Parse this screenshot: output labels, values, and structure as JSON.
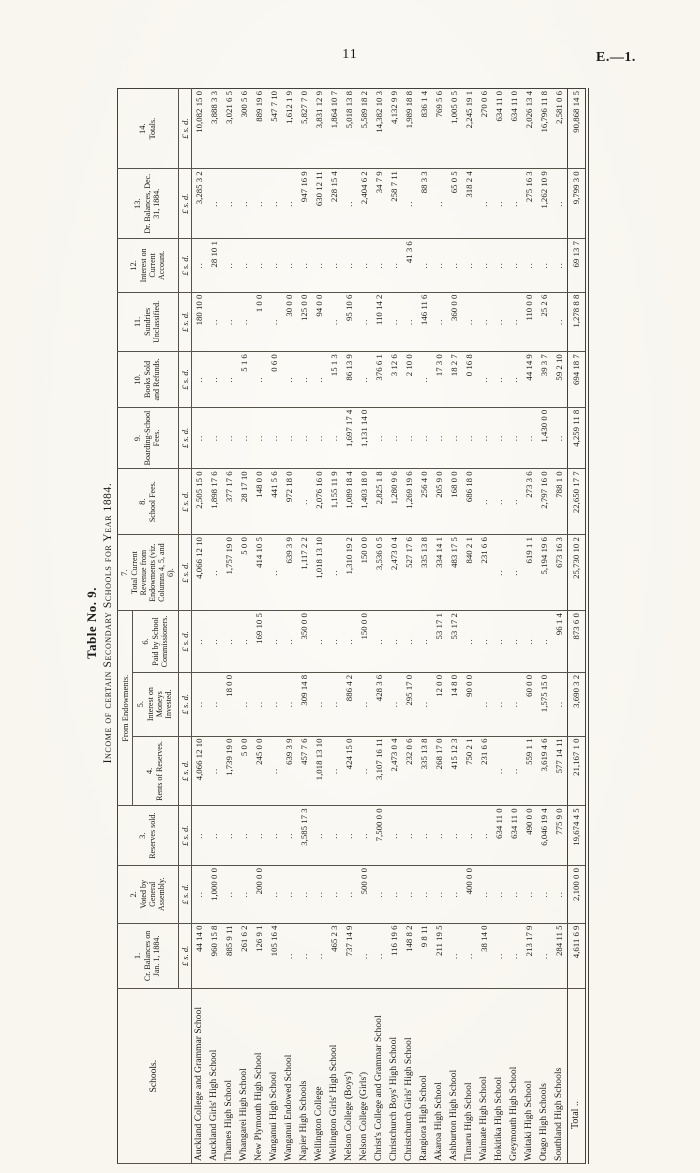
{
  "page": {
    "number": "11",
    "doc_ref": "E.—1."
  },
  "table": {
    "caption_line1": "Table No. 9.",
    "caption_line2": "Income of certain Secondary Schools for Year 1884.",
    "schools_header": "Schools.",
    "group_header": "From Endowments.",
    "money_unit": "£ s. d.",
    "columns": [
      {
        "num": "1.",
        "label": "Cr. Balances on Jan. 1, 1884.",
        "group": false
      },
      {
        "num": "2.",
        "label": "Voted by General Assembly.",
        "group": false
      },
      {
        "num": "3.",
        "label": "Reserves sold.",
        "group": false
      },
      {
        "num": "4.",
        "label": "Rents of Reserves.",
        "group": true
      },
      {
        "num": "5.",
        "label": "Interest on Moneys Invested.",
        "group": true
      },
      {
        "num": "6.",
        "label": "Paid by School Commissioners.",
        "group": true
      },
      {
        "num": "7.",
        "label": "Total Current Revenue from Endowments (viz. Columns 4, 5, and 6).",
        "group": false
      },
      {
        "num": "8.",
        "label": "School Fees.",
        "group": false
      },
      {
        "num": "9.",
        "label": "Boarding-School Fees.",
        "group": false
      },
      {
        "num": "10.",
        "label": "Books Sold and Refunds.",
        "group": false
      },
      {
        "num": "11.",
        "label": "Sundries Unclassified.",
        "group": false
      },
      {
        "num": "12.",
        "label": "Interest on Current Account.",
        "group": false
      },
      {
        "num": "13.",
        "label": "Dr. Balances, Dec. 31, 1884.",
        "group": false
      },
      {
        "num": "14.",
        "label": "Totals.",
        "group": false
      }
    ],
    "rows": [
      {
        "school": "Auckland College and Grammar School",
        "values": [
          "44 14 0",
          "..",
          "..",
          "4,066 12 10",
          "..",
          "..",
          "4,066 12 10",
          "2,505 15 0",
          "..",
          "..",
          "180 10 0",
          "..",
          "3,285 3 2",
          "10,082 15 0"
        ]
      },
      {
        "school": "Auckland Girls' High School",
        "values": [
          "960 15 8",
          "1,000 0 0",
          "..",
          "..",
          "..",
          "..",
          "..",
          "1,898 17 6",
          "..",
          "..",
          "..",
          "28 10 1",
          "..",
          "3,888 3 3"
        ]
      },
      {
        "school": "Thames High School",
        "values": [
          "885 9 11",
          "..",
          "..",
          "1,739 19 0",
          "18 0 0",
          "..",
          "1,757 19 0",
          "377 17 6",
          "..",
          "..",
          "..",
          "..",
          "..",
          "3,021 6 5"
        ]
      },
      {
        "school": "Whangarei High School",
        "values": [
          "261 6 2",
          "..",
          "..",
          "5 0 0",
          "..",
          "..",
          "5 0 0",
          "28 17 10",
          "..",
          "5 1 6",
          "..",
          "..",
          "..",
          "300 5 6"
        ]
      },
      {
        "school": "New Plymouth High School",
        "values": [
          "126 9 1",
          "200 0 0",
          "..",
          "245 0 0",
          "..",
          "169 10 5",
          "414 10 5",
          "148 0 0",
          "..",
          "..",
          "1 0 0",
          "..",
          "..",
          "889 19 6"
        ]
      },
      {
        "school": "Wanganui High School",
        "values": [
          "105 16 4",
          "..",
          "..",
          "..",
          "..",
          "..",
          "..",
          "441 5 6",
          "..",
          "0 6 0",
          "..",
          "..",
          "..",
          "547 7 10"
        ]
      },
      {
        "school": "Wanganui Endowed School",
        "values": [
          "..",
          "..",
          "..",
          "639 3 9",
          "..",
          "..",
          "639 3 9",
          "972 18 0",
          "..",
          "..",
          "30 0 0",
          "..",
          "..",
          "1,612 1 9"
        ]
      },
      {
        "school": "Napier High Schools",
        "values": [
          "..",
          "..",
          "3,585 17 3",
          "457 7 6",
          "309 14 8",
          "350 0 0",
          "1,117 2 2",
          "..",
          "..",
          "..",
          "125 0 0",
          "..",
          "947 16 9",
          "5,827 7 0"
        ]
      },
      {
        "school": "Wellington College",
        "values": [
          "..",
          "..",
          "..",
          "1,018 13 10",
          "..",
          "..",
          "1,018 13 10",
          "2,076 16 0",
          "..",
          "..",
          "94 0 0",
          "..",
          "630 12 11",
          "3,831 12 9"
        ]
      },
      {
        "school": "Wellington Girls' High School",
        "values": [
          "465 2 3",
          "..",
          "..",
          "..",
          "..",
          "..",
          "..",
          "1,155 11 9",
          "..",
          "15 1 3",
          "..",
          "..",
          "228 15 4",
          "1,864 10 7"
        ]
      },
      {
        "school": "Nelson College (Boys')",
        "values": [
          "737 14 9",
          "..",
          "..",
          "424 15 0",
          "886 4 2",
          "..",
          "1,310 19 2",
          "1,089 18 4",
          "1,697 17 4",
          "86 13 9",
          "95 10 6",
          "..",
          "..",
          "5,018 13 8"
        ]
      },
      {
        "school": "Nelson College (Girls')",
        "values": [
          "..",
          "500 0 0",
          "..",
          "..",
          "..",
          "150 0 0",
          "150 0 0",
          "1,403 18 0",
          "1,131 14 0",
          "..",
          "..",
          "..",
          "2,404 6 2",
          "5,589 18 2"
        ]
      },
      {
        "school": "Christ's College and Grammar School",
        "values": [
          "..",
          "..",
          "7,500 0 0",
          "3,107 16 11",
          "428 3 6",
          "..",
          "3,536 0 5",
          "2,825 1 8",
          "..",
          "376 6 1",
          "110 14 2",
          "..",
          "34 7 9",
          "14,382 10 3"
        ]
      },
      {
        "school": "Christchurch Boys' High School",
        "values": [
          "116 19 6",
          "..",
          "..",
          "2,473 0 4",
          "..",
          "..",
          "2,473 0 4",
          "1,280 9 6",
          "..",
          "3 12 6",
          "..",
          "..",
          "258 7 11",
          "4,132 9 9"
        ]
      },
      {
        "school": "Christchurch Girls' High School",
        "values": [
          "148 8 2",
          "..",
          "..",
          "232 0 6",
          "295 17 0",
          "..",
          "527 17 6",
          "1,269 19 6",
          "..",
          "2 10 0",
          "..",
          "41 3 6",
          "..",
          "1,989 18 8"
        ]
      },
      {
        "school": "Rangiora High School",
        "values": [
          "9 8 11",
          "..",
          "..",
          "335 13 8",
          "..",
          "..",
          "335 13 8",
          "256 4 0",
          "..",
          "..",
          "146 11 6",
          "..",
          "88 3 3",
          "836 1 4"
        ]
      },
      {
        "school": "Akaroa High School",
        "values": [
          "211 19 5",
          "..",
          "..",
          "268 17 0",
          "12 0 0",
          "53 17 1",
          "334 14 1",
          "205 9 0",
          "..",
          "17 3 0",
          "..",
          "..",
          "..",
          "769 5 6"
        ]
      },
      {
        "school": "Ashburton High School",
        "values": [
          "..",
          "..",
          "..",
          "415 12 3",
          "14 8 0",
          "53 17 2",
          "483 17 5",
          "168 0 0",
          "..",
          "18 2 7",
          "360 0 0",
          "..",
          "65 0 5",
          "1,005 0 5"
        ]
      },
      {
        "school": "Timaru High School",
        "values": [
          "..",
          "400 0 0",
          "..",
          "750 2 1",
          "90 0 0",
          "..",
          "840 2 1",
          "686 18 0",
          "..",
          "0 16 8",
          "..",
          "..",
          "318 2 4",
          "2,245 19 1"
        ]
      },
      {
        "school": "Waimate High School",
        "values": [
          "38 14 0",
          "..",
          "..",
          "231 6 6",
          "..",
          "..",
          "231 6 6",
          "..",
          "..",
          "..",
          "..",
          "..",
          "..",
          "270 0 6"
        ]
      },
      {
        "school": "Hokitika High School",
        "values": [
          "..",
          "..",
          "634 11 0",
          "..",
          "..",
          "..",
          "..",
          "..",
          "..",
          "..",
          "..",
          "..",
          "..",
          "634 11 0"
        ]
      },
      {
        "school": "Greymouth High School",
        "values": [
          "..",
          "..",
          "634 11 0",
          "..",
          "..",
          "..",
          "..",
          "..",
          "..",
          "..",
          "..",
          "..",
          "..",
          "634 11 0"
        ]
      },
      {
        "school": "Waitaki High School",
        "values": [
          "213 17 9",
          "..",
          "490 0 0",
          "559 1 1",
          "60 0 0",
          "..",
          "619 1 1",
          "273 3 6",
          "..",
          "44 14 9",
          "110 0 0",
          "..",
          "275 16 3",
          "2,026 13 4"
        ]
      },
      {
        "school": "Otago High Schools",
        "values": [
          "..",
          "..",
          "6,046 19 4",
          "3,619 4 6",
          "1,575 15 0",
          "..",
          "5,194 19 6",
          "2,797 16 0",
          "1,430 0 0",
          "39 3 7",
          "25 2 6",
          "..",
          "1,262 10 9",
          "16,796 11 8"
        ]
      },
      {
        "school": "Southland High Schools",
        "values": [
          "284 11 5",
          "..",
          "775 9 0",
          "577 14 11",
          "..",
          "96 1 4",
          "673 16 3",
          "788 1 0",
          "..",
          "59 2 10",
          "..",
          "..",
          "..",
          "2,581 0 6"
        ]
      }
    ],
    "total_row": {
      "label": "Total ..",
      "values": [
        "4,611 6 9",
        "2,100 0 0",
        "19,674 4 5",
        "21,167 1 0",
        "3,690 3 2",
        "873 6 0",
        "25,730 10 2",
        "22,650 17 7",
        "4,259 11 8",
        "694 18 7",
        "1,278 8 8",
        "69 13 7",
        "9,799 3 0",
        "90,868 14 5"
      ]
    }
  }
}
